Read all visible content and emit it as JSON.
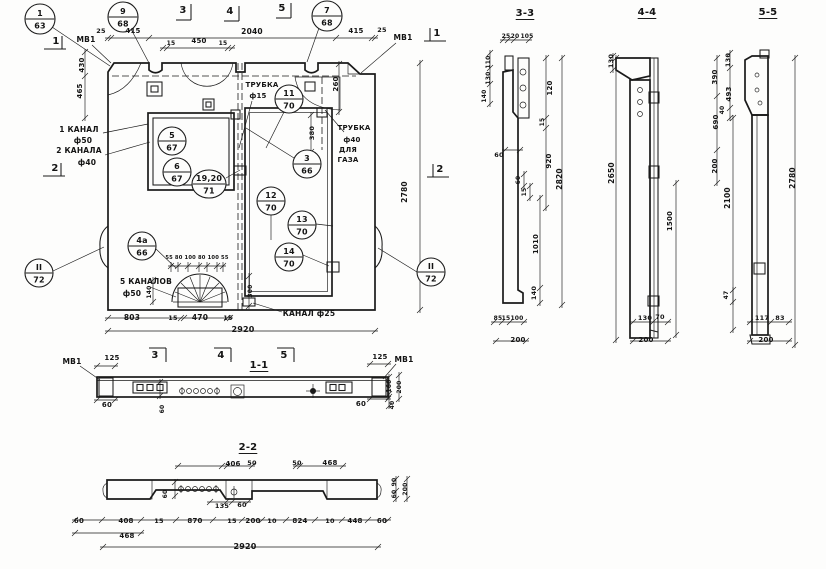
{
  "sheet": {
    "background": "#fdfdfc",
    "ink": "#1a1a1a"
  },
  "callouts": [
    {
      "top": "1",
      "bot": "63",
      "x": 40,
      "y": 19,
      "r": 15
    },
    {
      "top": "9",
      "bot": "68",
      "x": 123,
      "y": 17,
      "r": 15
    },
    {
      "top": "7",
      "bot": "68",
      "x": 327,
      "y": 16,
      "r": 15
    },
    {
      "top": "11",
      "bot": "70",
      "x": 289,
      "y": 99,
      "r": 14
    },
    {
      "top": "5",
      "bot": "67",
      "x": 172,
      "y": 141,
      "r": 14
    },
    {
      "top": "6",
      "bot": "67",
      "x": 177,
      "y": 172,
      "r": 14
    },
    {
      "top": "19,20",
      "bot": "71",
      "x": 209,
      "y": 184,
      "r": 14,
      "rx": 17
    },
    {
      "top": "3",
      "bot": "66",
      "x": 307,
      "y": 164,
      "r": 14
    },
    {
      "top": "12",
      "bot": "70",
      "x": 271,
      "y": 201,
      "r": 14
    },
    {
      "top": "13",
      "bot": "70",
      "x": 302,
      "y": 225,
      "r": 14
    },
    {
      "top": "14",
      "bot": "70",
      "x": 289,
      "y": 257,
      "r": 14
    },
    {
      "top": "4а",
      "bot": "66",
      "x": 142,
      "y": 246,
      "r": 14
    },
    {
      "top": "II",
      "bot": "72",
      "x": 39,
      "y": 273,
      "r": 14
    },
    {
      "top": "II",
      "bot": "72",
      "x": 431,
      "y": 272,
      "r": 14
    }
  ],
  "labels": [
    {
      "t": "МВ1",
      "x": 86,
      "y": 42,
      "s": 7.5,
      "n": "label-mv1"
    },
    {
      "t": "1",
      "x": 56,
      "y": 44,
      "s": 10,
      "n": "section-mark"
    },
    {
      "t": "25",
      "x": 101,
      "y": 33,
      "s": 6.5
    },
    {
      "t": "415",
      "x": 133,
      "y": 33,
      "s": 7
    },
    {
      "t": "2040",
      "x": 252,
      "y": 34,
      "s": 7.5
    },
    {
      "t": "415",
      "x": 356,
      "y": 33,
      "s": 7
    },
    {
      "t": "25",
      "x": 382,
      "y": 32,
      "s": 6.5
    },
    {
      "t": "МВ1",
      "x": 403,
      "y": 40,
      "s": 7.5,
      "n": "label-mv1"
    },
    {
      "t": "1",
      "x": 437,
      "y": 36,
      "s": 10,
      "n": "section-mark"
    },
    {
      "t": "3",
      "x": 183,
      "y": 13,
      "s": 10,
      "n": "section-mark"
    },
    {
      "t": "4",
      "x": 230,
      "y": 14,
      "s": 10,
      "n": "section-mark"
    },
    {
      "t": "5",
      "x": 282,
      "y": 11,
      "s": 10,
      "n": "section-mark"
    },
    {
      "t": "15",
      "x": 171,
      "y": 45,
      "s": 6
    },
    {
      "t": "450",
      "x": 199,
      "y": 43,
      "s": 7
    },
    {
      "t": "15",
      "x": 223,
      "y": 45,
      "s": 6
    },
    {
      "t": "430",
      "x": 84,
      "y": 65,
      "s": 7,
      "r": -90
    },
    {
      "t": "465",
      "x": 82,
      "y": 91,
      "s": 7,
      "r": -90
    },
    {
      "t": "260",
      "x": 338,
      "y": 84,
      "s": 7,
      "r": -90
    },
    {
      "t": "ТРУБКА",
      "x": 262,
      "y": 87,
      "s": 7,
      "n": "note-tube-15"
    },
    {
      "t": "ф15",
      "x": 258,
      "y": 98,
      "s": 7
    },
    {
      "t": "ТРУБКА",
      "x": 354,
      "y": 130,
      "s": 7,
      "n": "note-tube-gas"
    },
    {
      "t": "ф40",
      "x": 352,
      "y": 142,
      "s": 7
    },
    {
      "t": "ДЛЯ",
      "x": 348,
      "y": 152,
      "s": 7
    },
    {
      "t": "ГАЗА",
      "x": 348,
      "y": 162,
      "s": 7
    },
    {
      "t": "1 КАНАЛ",
      "x": 79,
      "y": 132,
      "s": 7.5,
      "n": "note-1-kanal"
    },
    {
      "t": "ф50",
      "x": 83,
      "y": 143,
      "s": 7.5
    },
    {
      "t": "2 КАНАЛА",
      "x": 79,
      "y": 153,
      "s": 7.5,
      "n": "note-2-kanala"
    },
    {
      "t": "ф40",
      "x": 87,
      "y": 165,
      "s": 7.5
    },
    {
      "t": "2",
      "x": 55,
      "y": 171,
      "s": 10,
      "n": "section-mark"
    },
    {
      "t": "2",
      "x": 440,
      "y": 172,
      "s": 10,
      "n": "section-mark"
    },
    {
      "t": "380",
      "x": 314,
      "y": 133,
      "s": 6.5,
      "r": -90
    },
    {
      "t": "2780",
      "x": 407,
      "y": 192,
      "s": 7.5,
      "r": -90
    },
    {
      "t": "5 КАНАЛОВ",
      "x": 146,
      "y": 284,
      "s": 7.5,
      "n": "note-5-kanalov"
    },
    {
      "t": "ф50",
      "x": 132,
      "y": 296,
      "s": 7.5
    },
    {
      "t": "55 80 100 80 100 55",
      "x": 197,
      "y": 259,
      "s": 5.2
    },
    {
      "t": "140",
      "x": 151,
      "y": 292,
      "s": 6,
      "r": -90
    },
    {
      "t": "300",
      "x": 252,
      "y": 291,
      "s": 6,
      "r": -90
    },
    {
      "t": "803",
      "x": 132,
      "y": 320,
      "s": 7.5
    },
    {
      "t": "15",
      "x": 173,
      "y": 320,
      "s": 6.5
    },
    {
      "t": "470",
      "x": 200,
      "y": 320,
      "s": 7.5
    },
    {
      "t": "15",
      "x": 228,
      "y": 320,
      "s": 6.5
    },
    {
      "t": "2920",
      "x": 243,
      "y": 332,
      "s": 8
    },
    {
      "t": "КАНАЛ ф25",
      "x": 309,
      "y": 316,
      "s": 7.5,
      "n": "note-kanal-25"
    },
    {
      "t": "3",
      "x": 155,
      "y": 358,
      "s": 10,
      "n": "section-mark"
    },
    {
      "t": "4",
      "x": 221,
      "y": 358,
      "s": 10,
      "n": "section-mark"
    },
    {
      "t": "5",
      "x": 284,
      "y": 358,
      "s": 10,
      "n": "section-mark"
    },
    {
      "t": "1-1",
      "x": 259,
      "y": 368,
      "s": 10,
      "n": "section-title",
      "u": 1
    },
    {
      "t": "125",
      "x": 112,
      "y": 360,
      "s": 7
    },
    {
      "t": "125",
      "x": 380,
      "y": 359,
      "s": 7
    },
    {
      "t": "МВ1",
      "x": 72,
      "y": 364,
      "s": 7.5,
      "n": "label-mv1"
    },
    {
      "t": "МВ1",
      "x": 404,
      "y": 362,
      "s": 7.5,
      "n": "label-mv1"
    },
    {
      "t": "60",
      "x": 107,
      "y": 407,
      "s": 7
    },
    {
      "t": "60",
      "x": 361,
      "y": 406,
      "s": 7
    },
    {
      "t": "60",
      "x": 164,
      "y": 409,
      "s": 6,
      "r": -90
    },
    {
      "t": "160",
      "x": 391,
      "y": 386,
      "s": 6,
      "r": -90
    },
    {
      "t": "200",
      "x": 401,
      "y": 387,
      "s": 6,
      "r": -90
    },
    {
      "t": "40",
      "x": 394,
      "y": 405,
      "s": 6,
      "r": -90
    },
    {
      "t": "2-2",
      "x": 248,
      "y": 450,
      "s": 10,
      "n": "section-title",
      "u": 1
    },
    {
      "t": "406",
      "x": 233,
      "y": 466,
      "s": 7
    },
    {
      "t": "50",
      "x": 252,
      "y": 465,
      "s": 6.5
    },
    {
      "t": "50",
      "x": 297,
      "y": 465,
      "s": 6.5
    },
    {
      "t": "468",
      "x": 330,
      "y": 465,
      "s": 7
    },
    {
      "t": "60",
      "x": 167,
      "y": 494,
      "s": 6,
      "r": -90
    },
    {
      "t": "135",
      "x": 222,
      "y": 508,
      "s": 6.5
    },
    {
      "t": "60",
      "x": 242,
      "y": 507,
      "s": 6.5
    },
    {
      "t": "90",
      "x": 396,
      "y": 482,
      "s": 6,
      "r": -90
    },
    {
      "t": "60",
      "x": 396,
      "y": 494,
      "s": 6,
      "r": -90
    },
    {
      "t": "200",
      "x": 407,
      "y": 489,
      "s": 6,
      "r": -90
    },
    {
      "t": "60",
      "x": 79,
      "y": 523,
      "s": 7
    },
    {
      "t": "408",
      "x": 126,
      "y": 523,
      "s": 7
    },
    {
      "t": "15",
      "x": 159,
      "y": 523,
      "s": 6.5
    },
    {
      "t": "870",
      "x": 195,
      "y": 523,
      "s": 7
    },
    {
      "t": "15",
      "x": 232,
      "y": 523,
      "s": 6.5
    },
    {
      "t": "200",
      "x": 253,
      "y": 523,
      "s": 7
    },
    {
      "t": "10",
      "x": 272,
      "y": 523,
      "s": 6.5
    },
    {
      "t": "824",
      "x": 300,
      "y": 523,
      "s": 7
    },
    {
      "t": "10",
      "x": 330,
      "y": 523,
      "s": 6.5
    },
    {
      "t": "448",
      "x": 355,
      "y": 523,
      "s": 7
    },
    {
      "t": "60",
      "x": 382,
      "y": 523,
      "s": 7
    },
    {
      "t": "468",
      "x": 127,
      "y": 538,
      "s": 7
    },
    {
      "t": "2920",
      "x": 245,
      "y": 549,
      "s": 8
    },
    {
      "t": "3-3",
      "x": 525,
      "y": 16,
      "s": 10,
      "n": "section-title",
      "u": 1
    },
    {
      "t": "25",
      "x": 506,
      "y": 38,
      "s": 6
    },
    {
      "t": "20",
      "x": 515,
      "y": 38,
      "s": 6
    },
    {
      "t": "105",
      "x": 527,
      "y": 38,
      "s": 6
    },
    {
      "t": "110",
      "x": 490,
      "y": 62,
      "s": 6,
      "r": -90
    },
    {
      "t": "130",
      "x": 490,
      "y": 78,
      "s": 6,
      "r": -90
    },
    {
      "t": "140",
      "x": 486,
      "y": 96,
      "s": 6,
      "r": -90
    },
    {
      "t": "60",
      "x": 499,
      "y": 157,
      "s": 6.5
    },
    {
      "t": "120",
      "x": 552,
      "y": 88,
      "s": 7,
      "r": -90
    },
    {
      "t": "15",
      "x": 544,
      "y": 122,
      "s": 6,
      "r": -90
    },
    {
      "t": "920",
      "x": 551,
      "y": 161,
      "s": 7,
      "r": -90
    },
    {
      "t": "2820",
      "x": 562,
      "y": 179,
      "s": 7.5,
      "r": -90
    },
    {
      "t": "60",
      "x": 520,
      "y": 180,
      "s": 6,
      "r": -90
    },
    {
      "t": "15",
      "x": 526,
      "y": 192,
      "s": 6,
      "r": -90
    },
    {
      "t": "1010",
      "x": 538,
      "y": 244,
      "s": 7,
      "r": -90
    },
    {
      "t": "140",
      "x": 536,
      "y": 293,
      "s": 6.5,
      "r": -90
    },
    {
      "t": "85",
      "x": 498,
      "y": 320,
      "s": 6
    },
    {
      "t": "15",
      "x": 506,
      "y": 320,
      "s": 6
    },
    {
      "t": "100",
      "x": 517,
      "y": 320,
      "s": 6
    },
    {
      "t": "200",
      "x": 518,
      "y": 342,
      "s": 7
    },
    {
      "t": "4-4",
      "x": 647,
      "y": 15,
      "s": 10,
      "n": "section-title",
      "u": 1
    },
    {
      "t": "130",
      "x": 613,
      "y": 61,
      "s": 6.5,
      "r": -90
    },
    {
      "t": "2650",
      "x": 614,
      "y": 173,
      "s": 7.5,
      "r": -90
    },
    {
      "t": "390",
      "x": 717,
      "y": 77,
      "s": 7,
      "r": -90
    },
    {
      "t": "690",
      "x": 718,
      "y": 122,
      "s": 7,
      "r": -90
    },
    {
      "t": "200",
      "x": 717,
      "y": 166,
      "s": 7,
      "r": -90
    },
    {
      "t": "1500",
      "x": 672,
      "y": 221,
      "s": 7,
      "r": -90
    },
    {
      "t": "130",
      "x": 645,
      "y": 320,
      "s": 6.5
    },
    {
      "t": "70",
      "x": 660,
      "y": 319,
      "s": 6.5
    },
    {
      "t": "200",
      "x": 646,
      "y": 342,
      "s": 7
    },
    {
      "t": "5-5",
      "x": 768,
      "y": 15,
      "s": 10,
      "n": "section-title",
      "u": 1
    },
    {
      "t": "130",
      "x": 730,
      "y": 60,
      "s": 6.5,
      "r": -90
    },
    {
      "t": "493",
      "x": 731,
      "y": 94,
      "s": 7,
      "r": -90
    },
    {
      "t": "40",
      "x": 724,
      "y": 110,
      "s": 6,
      "r": -90
    },
    {
      "t": "2100",
      "x": 730,
      "y": 198,
      "s": 7.5,
      "r": -90
    },
    {
      "t": "47",
      "x": 728,
      "y": 295,
      "s": 6,
      "r": -90
    },
    {
      "t": "2780",
      "x": 795,
      "y": 178,
      "s": 7.5,
      "r": -90
    },
    {
      "t": "117",
      "x": 762,
      "y": 320,
      "s": 6.5
    },
    {
      "t": "83",
      "x": 780,
      "y": 320,
      "s": 6.5
    },
    {
      "t": "200",
      "x": 766,
      "y": 342,
      "s": 7
    }
  ]
}
